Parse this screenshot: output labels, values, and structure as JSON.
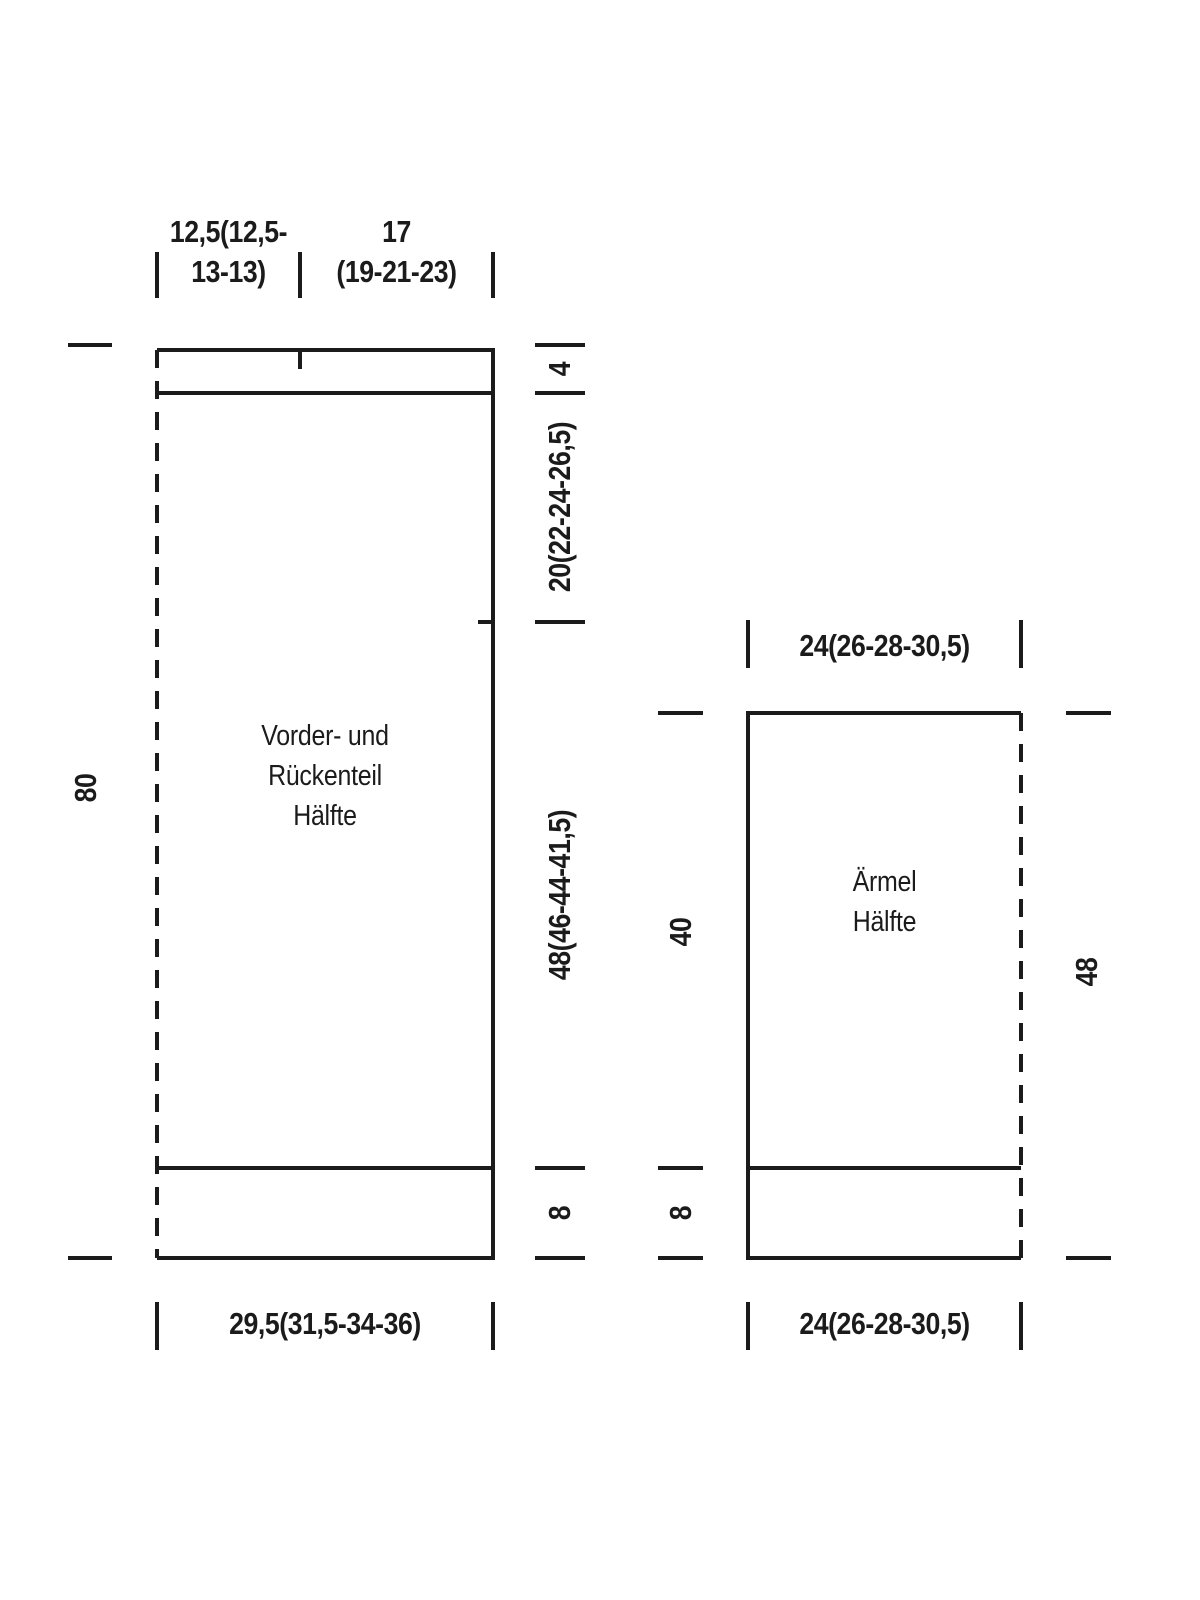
{
  "colors": {
    "background": "#ffffff",
    "ink": "#1b1b1b"
  },
  "front_back": {
    "label_line1": "Vorder- und",
    "label_line2": "Rückenteil",
    "label_line3": "Hälfte",
    "dim_top_left_line1": "12,5(12,5-",
    "dim_top_left_line2": "13-13)",
    "dim_top_right_line1": "17",
    "dim_top_right_line2": "(19-21-23)",
    "dim_left_height": "80",
    "dim_right_neckband": "4",
    "dim_right_yoke": "20(22-24-26,5)",
    "dim_right_body": "48(46-44-41,5)",
    "dim_right_ribbing": "8",
    "dim_bottom_width": "29,5(31,5-34-36)"
  },
  "sleeve": {
    "label_line1": "Ärmel",
    "label_line2": "Hälfte",
    "dim_top_width": "24(26-28-30,5)",
    "dim_left_length": "40",
    "dim_left_cuff": "8",
    "dim_right_length": "48",
    "dim_bottom_width": "24(26-28-30,5)"
  }
}
